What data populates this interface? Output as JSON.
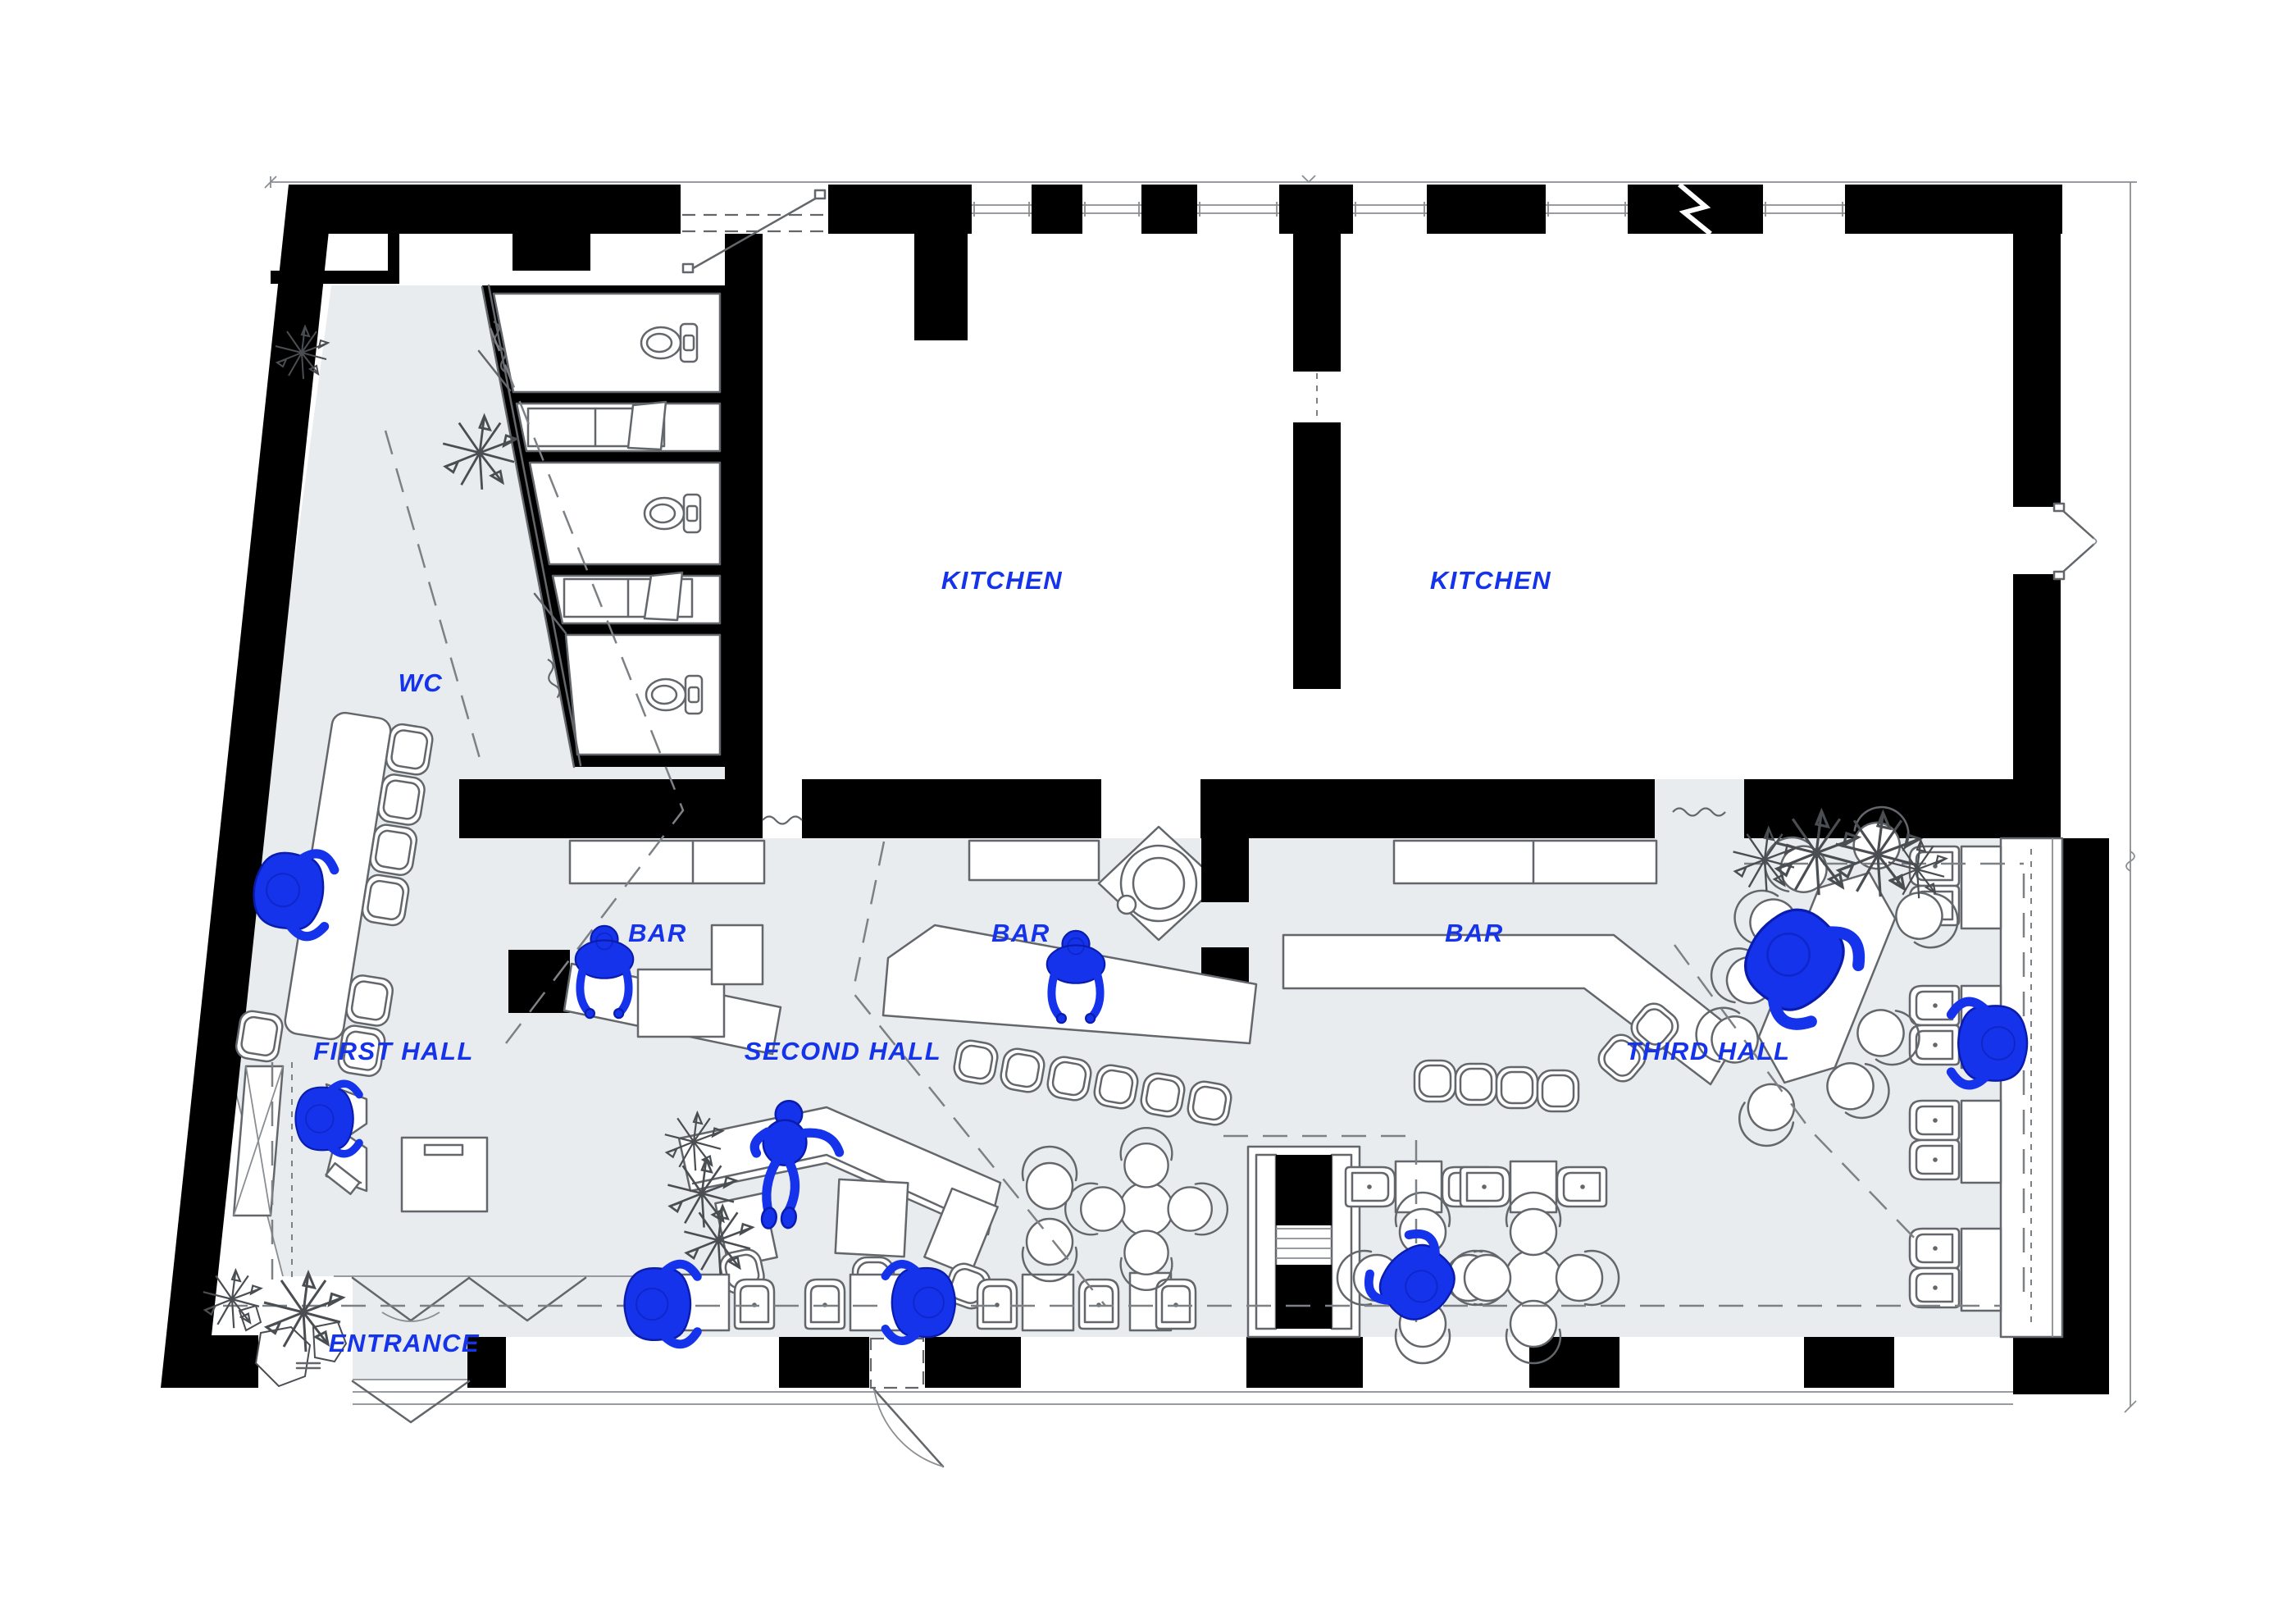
{
  "title": "Restaurant floor plan",
  "colors": {
    "accent": "#1533ea",
    "floor": "#e8ecef",
    "wall": "#000000",
    "line": "#63676b",
    "dash": "#7d8185",
    "dim": "#8a8e92",
    "person_stroke": "#0a1cae"
  },
  "labels": {
    "wc": "WC",
    "kitchen": "KITCHEN",
    "bar": "BAR",
    "first_hall": "FIRST HALL",
    "second_hall": "SECOND HALL",
    "third_hall": "THIRD HALL",
    "entrance": "ENTRANCE"
  }
}
